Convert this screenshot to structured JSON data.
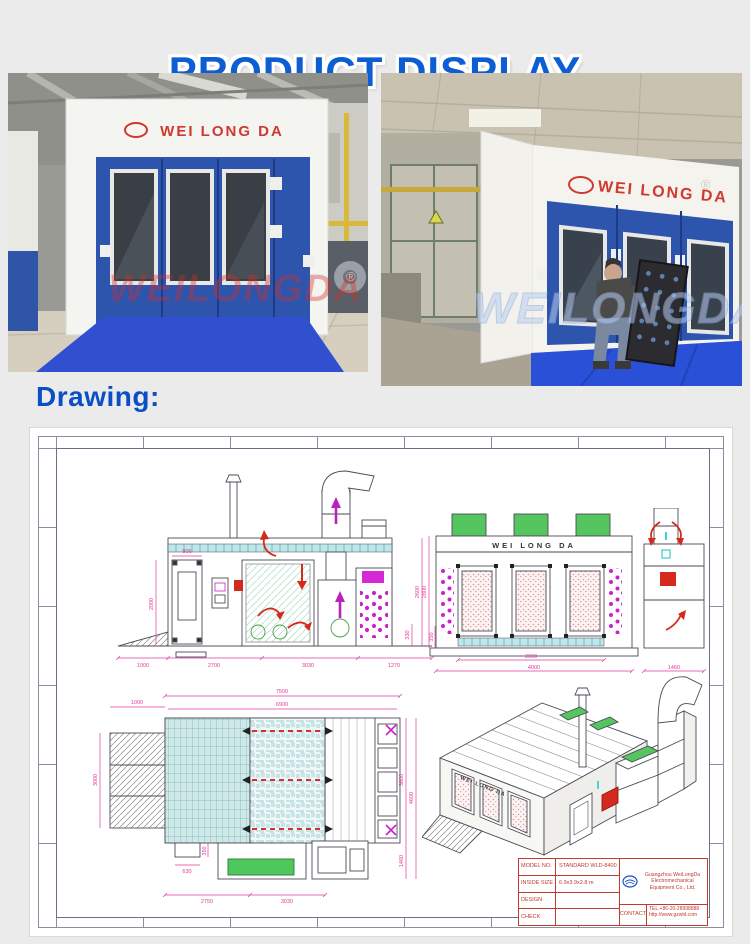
{
  "header": {
    "title": "PRODUCT DISPLAY"
  },
  "photos": {
    "brand": "WEI LONG DA",
    "registered_mark": "®",
    "left": {
      "watermark": "WEILONGDA"
    },
    "right": {
      "watermark": "WEILONGDA"
    }
  },
  "drawing_section": {
    "label": "Drawing:"
  },
  "sheet": {
    "brand": "WEI LONG DA",
    "side_view": {
      "dim_door_width": "806",
      "dim_door_height": "2000",
      "dims_bottom": [
        "1000",
        "2700",
        "3030",
        "1270"
      ],
      "dim_height": "2600",
      "dim_base": "330"
    },
    "front_view": {
      "dims_bottom": [
        "3000",
        "4000",
        "1460"
      ],
      "dim_height": "2800",
      "dim_base": "350"
    },
    "plan_view": {
      "dim_ramp_width": "1000",
      "dim_total_length": "7500",
      "dim_inner_length": "6900",
      "dim_ramp_depth": "3000",
      "dim_inner_width": "3600",
      "dim_total_width": "4600",
      "dim_unit_width": "1460",
      "dims_bottom": [
        "2750",
        "3030"
      ],
      "dim_small_1": "630",
      "dim_small_2": "350"
    },
    "title_block": {
      "rows": [
        {
          "label": "MODEL NO.",
          "value": "STANDARD WLD-8400"
        },
        {
          "label": "INSIDE SIZE",
          "value": "6.9x3.9x2.8 m"
        },
        {
          "label": "DESIGN",
          "value": ""
        },
        {
          "label": "CHECK",
          "value": ""
        }
      ],
      "company_line1": "Guangzhou WeiLongDa Electromechanical",
      "company_line2": "Equipment Co., Ltd.",
      "contact_label": "CONTACT",
      "tel": "TEL.+86-20-28998888",
      "web": "http://www.gzwld.com"
    }
  },
  "colors": {
    "accent": "#0c5ed2",
    "dimension": "#e23a9b",
    "booth_blue": "#2e55ad",
    "mat_blue": "#2b50d8",
    "green": "#55c560",
    "red": "#d42a1e"
  }
}
